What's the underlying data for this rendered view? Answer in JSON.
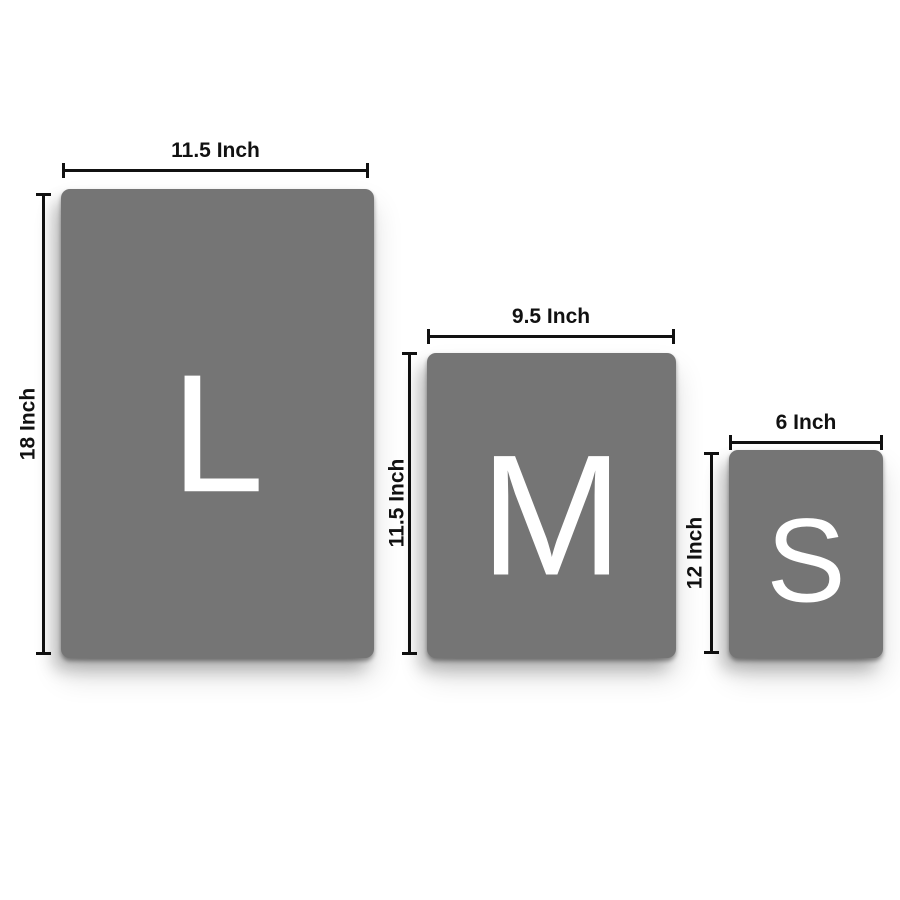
{
  "colors": {
    "background": "#ffffff",
    "panel": "#757575",
    "letter": "#ffffff",
    "dimension": "#111111"
  },
  "sizes": [
    {
      "letter": "L",
      "width_label": "11.5 Inch",
      "height_label": "18 Inch"
    },
    {
      "letter": "M",
      "width_label": "9.5 Inch",
      "height_label": "11.5 Inch"
    },
    {
      "letter": "S",
      "width_label": "6 Inch",
      "height_label": "12 Inch"
    }
  ]
}
